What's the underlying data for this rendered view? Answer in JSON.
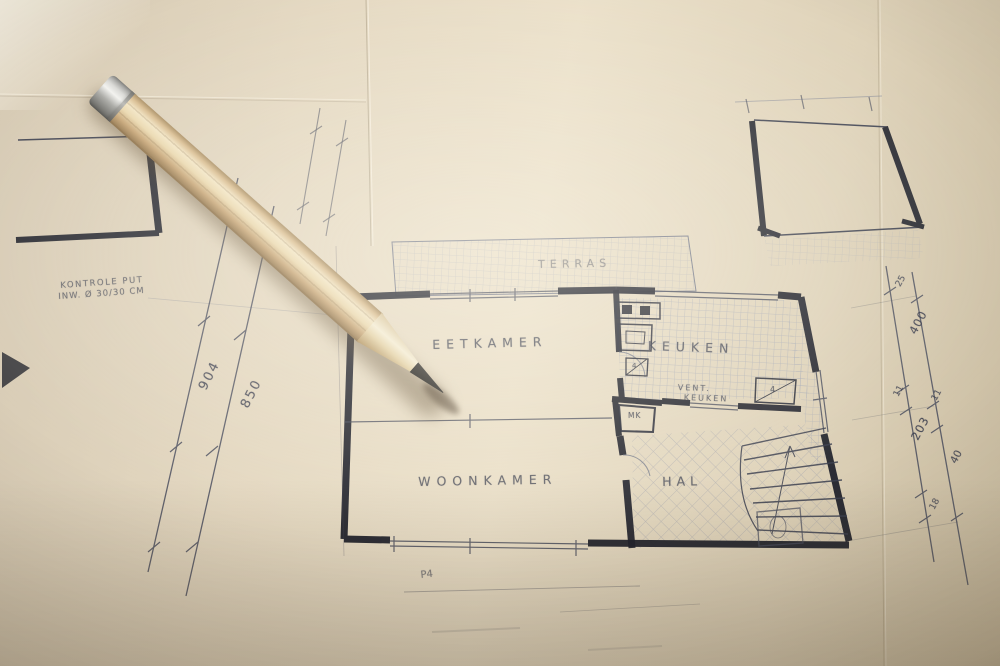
{
  "blueprint": {
    "rooms": {
      "terras": "TERRAS",
      "eetkamer": "EETKAMER",
      "keuken": "KEUKEN",
      "woonkamer": "WOONKAMER",
      "hal": "HAL",
      "mk": "MK"
    },
    "annotations": {
      "vent_line1": "VENT.",
      "vent_line2": "KEUKEN",
      "kontrole_line1": "KONTROLE PUT",
      "kontrole_line2": "INW. Ø 30/30 CM",
      "p4": "P4",
      "vent_mark_a": "4",
      "vent_mark_b": "4"
    },
    "dimensions_left": [
      "904",
      "850"
    ],
    "dimensions_right": [
      "25",
      "400",
      "11",
      "11",
      "203",
      "40",
      "18"
    ]
  },
  "colors": {
    "paper": "#e6dac2",
    "ink_dark": "#20222c",
    "ink_medium": "#3c4050",
    "ink_faint": "#7c8296",
    "pencil_wood": "#d9bd92",
    "pencil_graphite": "#34322e",
    "ferrule_metal": "#bfbfbd"
  }
}
